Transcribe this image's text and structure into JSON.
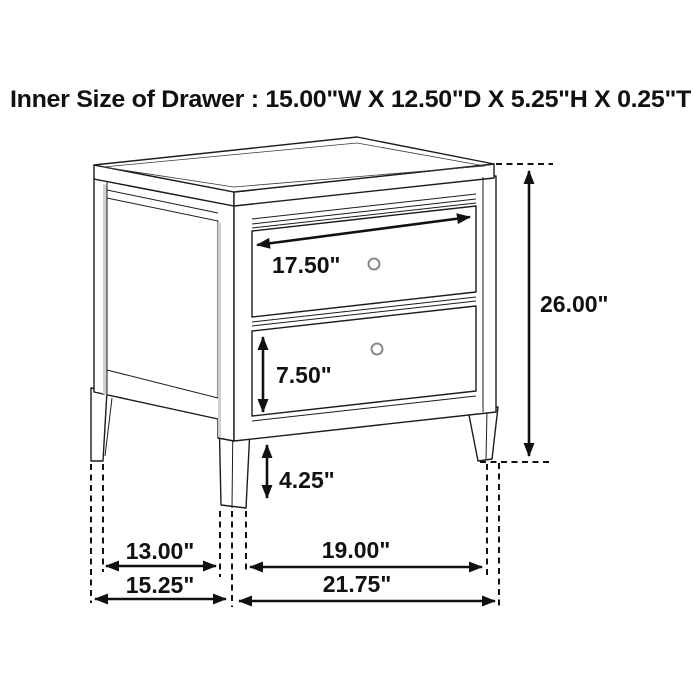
{
  "title": "Inner Size of Drawer : 15.00\"W X 12.50\"D X 5.25\"H X 0.25\"T",
  "diagram": {
    "type": "furniture-dimension-diagram",
    "subject": "two-drawer nightstand line drawing with dimension arrows",
    "inner_drawer_size": {
      "width": "15.00\"",
      "depth": "12.50\"",
      "height": "5.25\"",
      "thickness": "0.25\""
    },
    "colors": {
      "line": "#1c1c1c",
      "background": "#ffffff",
      "dimension": "#111111",
      "knob_stroke": "#8a8a8a",
      "panel_shading": "#cfcfcf"
    }
  },
  "labels": {
    "drawer_width": "17.50\"",
    "drawer_height": "7.50\"",
    "base_clearance": "4.25\"",
    "overall_height": "26.00\"",
    "side_leg_span_inner": "13.00\"",
    "side_depth_overall": "15.25\"",
    "front_leg_span_inner": "19.00\"",
    "front_width_overall": "21.75\""
  }
}
